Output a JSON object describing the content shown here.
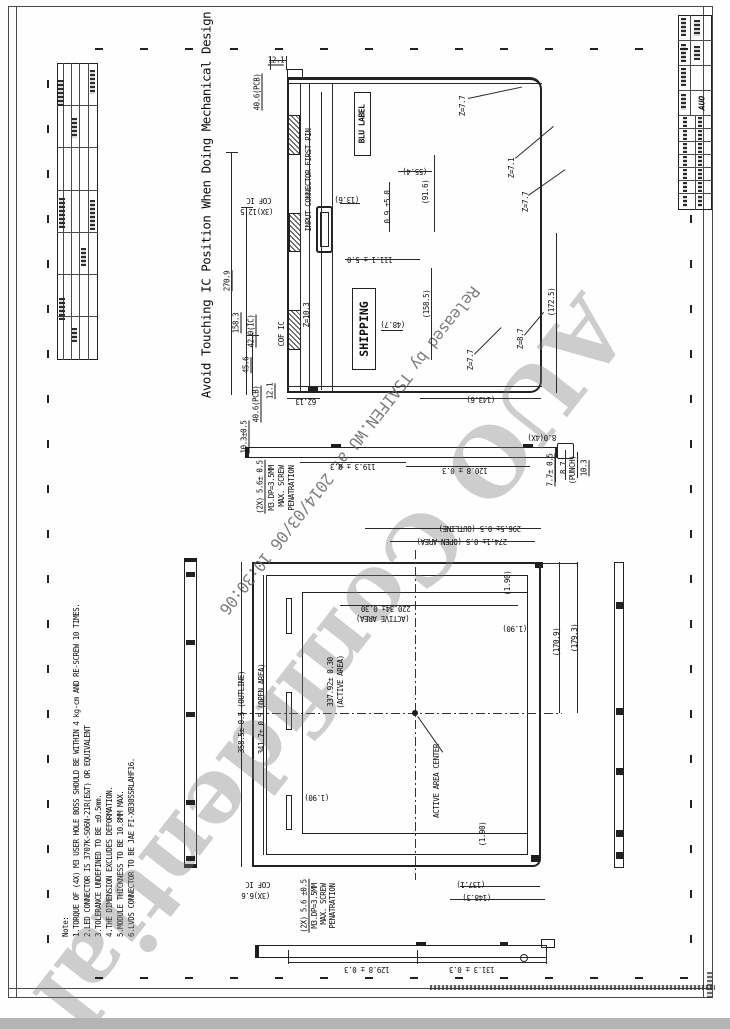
{
  "drawing": {
    "warning_title": "Avoid Touching IC Position When Doing Mechanical Design",
    "watermark_released": "Released by TSAIFEN.WU at 2014/03/06 10:30:06",
    "watermark_confidential": "AUO Confidential",
    "logo": "AUO",
    "blu_label": "BLU LABEL",
    "shipping_label": "SHIPPING"
  },
  "notes": {
    "heading": "Note:",
    "items": [
      "1.TORQUE OF (4X) M3 USER HOLE BOSS SHOULD BE WITHIN 4 kg-cm AND RE-SCREW 10 TIMES.",
      "2.LED CONNECTOR IS 3707K-S06N-21R(E&T) OR EQUIVALENT",
      "3.TOLERANCE UNDEFINED TO BE ±0.5mm.",
      "4.THE DIMENSION EXCLUDES DEFORMATION.",
      "5.MODULE THICKNESS TO BE 10.8MM MAX.",
      "6.LVDS CONNECTOR TO BE JAE FI-XB30SSRLAHF16."
    ]
  },
  "dims": [
    {
      "t": "12.1",
      "x": 276,
      "y": 61,
      "r": 0,
      "u": 1
    },
    {
      "t": "40.6(PCB)",
      "x": 258,
      "y": 92,
      "r": -90,
      "u": 1
    },
    {
      "t": "INPUT CONNECTOR FIRST PIN",
      "x": 309,
      "y": 180,
      "r": -90
    },
    {
      "t": "COF IC",
      "x": 259,
      "y": 200,
      "r": 180
    },
    {
      "t": "(3X)12.5",
      "x": 257,
      "y": 211,
      "r": 180
    },
    {
      "t": "(55.4)",
      "x": 415,
      "y": 171,
      "r": 180
    },
    {
      "t": "(13.6)",
      "x": 347,
      "y": 199,
      "r": 180
    },
    {
      "t": "0.9 ±5.0",
      "x": 388,
      "y": 207,
      "r": -90
    },
    {
      "t": "(91.6)",
      "x": 426,
      "y": 192,
      "r": -90
    },
    {
      "t": "Z=7.7",
      "x": 463,
      "y": 106,
      "r": -90
    },
    {
      "t": "Z=7.1",
      "x": 512,
      "y": 168,
      "r": -90
    },
    {
      "t": "Z=7.7",
      "x": 526,
      "y": 202,
      "r": -90
    },
    {
      "t": "111.1 ± 5.0",
      "x": 370,
      "y": 259,
      "r": 180
    },
    {
      "t": "Z=10.3",
      "x": 307,
      "y": 315,
      "r": -90
    },
    {
      "t": "COF IC",
      "x": 282,
      "y": 334,
      "r": -90
    },
    {
      "t": "42.0(IC)",
      "x": 252,
      "y": 331,
      "r": -90,
      "u": 1
    },
    {
      "t": "45.6",
      "x": 247,
      "y": 365,
      "r": -90,
      "u": 1
    },
    {
      "t": "158.3",
      "x": 237,
      "y": 323,
      "r": -90,
      "u": 1
    },
    {
      "t": "270.9",
      "x": 228,
      "y": 281,
      "r": -90,
      "u": 1
    },
    {
      "t": "(158.5)",
      "x": 427,
      "y": 304,
      "r": -90
    },
    {
      "t": "(48.7)",
      "x": 393,
      "y": 324,
      "r": 180
    },
    {
      "t": "Z=8.7",
      "x": 521,
      "y": 339,
      "r": -90
    },
    {
      "t": "(172.5)",
      "x": 552,
      "y": 302,
      "r": -90
    },
    {
      "t": "Z=7.7",
      "x": 471,
      "y": 360,
      "r": -90
    },
    {
      "t": "(143.6)",
      "x": 481,
      "y": 399,
      "r": 180
    },
    {
      "t": "62.13",
      "x": 306,
      "y": 401,
      "r": 180
    },
    {
      "t": "12.1",
      "x": 271,
      "y": 391,
      "r": -90,
      "u": 1
    },
    {
      "t": "40.6(PCB)",
      "x": 257,
      "y": 404,
      "r": -90,
      "u": 1
    },
    {
      "t": "10.3±0.5",
      "x": 245,
      "y": 437,
      "r": -90,
      "u": 1
    },
    {
      "t": "(2X) 5.6± 0.5",
      "x": 261,
      "y": 487,
      "r": -90,
      "u": 1
    },
    {
      "t": "M3.DP=3.5MM",
      "x": 272,
      "y": 488,
      "r": -90
    },
    {
      "t": "MAX. SCREW",
      "x": 282,
      "y": 486,
      "r": -90
    },
    {
      "t": "PENATRATION",
      "x": 292,
      "y": 488,
      "r": -90
    },
    {
      "t": "119.3 ± 0.3",
      "x": 353,
      "y": 466,
      "r": 180
    },
    {
      "t": "120.8 ± 0.3",
      "x": 465,
      "y": 470,
      "r": 180
    },
    {
      "t": "8.0(4X)",
      "x": 542,
      "y": 437,
      "r": 180
    },
    {
      "t": "7.7± 0.5",
      "x": 551,
      "y": 470,
      "r": -90,
      "u": 1
    },
    {
      "t": "8.7",
      "x": 564,
      "y": 468,
      "r": -90
    },
    {
      "t": "(PUNCH)",
      "x": 573,
      "y": 470,
      "r": -90
    },
    {
      "t": "10.3",
      "x": 585,
      "y": 468,
      "r": -90,
      "u": 1
    },
    {
      "t": "296.5± 0.5 (OUTLINE)",
      "x": 480,
      "y": 528,
      "r": 180
    },
    {
      "t": "274.1± 0.5 (OPEN AREA)",
      "x": 462,
      "y": 541,
      "r": 180
    },
    {
      "t": "220.34± 0.30",
      "x": 386,
      "y": 608,
      "r": 180
    },
    {
      "t": "(ACTIVE AREA)",
      "x": 383,
      "y": 618,
      "r": 180
    },
    {
      "t": "(1.90)",
      "x": 508,
      "y": 583,
      "r": -90
    },
    {
      "t": "(1.90)",
      "x": 515,
      "y": 628,
      "r": 180
    },
    {
      "t": "(170.9)",
      "x": 557,
      "y": 642,
      "r": -90
    },
    {
      "t": "(179.3)",
      "x": 575,
      "y": 638,
      "r": -90
    },
    {
      "t": "358.5± 0.5 (OUTLINE)",
      "x": 242,
      "y": 712,
      "r": -90
    },
    {
      "t": "341.7± 0.5 (OPEN AREA)",
      "x": 262,
      "y": 709,
      "r": -90
    },
    {
      "t": "337.92± 0.30",
      "x": 331,
      "y": 682,
      "r": -90
    },
    {
      "t": "(ACTIVE AREA)",
      "x": 341,
      "y": 682,
      "r": -90
    },
    {
      "t": "(1.90)",
      "x": 317,
      "y": 797,
      "r": 180
    },
    {
      "t": "ACTIVE AREA CENTER",
      "x": 437,
      "y": 781,
      "r": -90
    },
    {
      "t": "(1.90)",
      "x": 483,
      "y": 834,
      "r": -90
    },
    {
      "t": "(137.1)",
      "x": 471,
      "y": 884,
      "r": 180
    },
    {
      "t": "(148.3)",
      "x": 477,
      "y": 897,
      "r": 180
    },
    {
      "t": "COF IC",
      "x": 258,
      "y": 884,
      "r": 180
    },
    {
      "t": "(3X)6.6",
      "x": 256,
      "y": 895,
      "r": 180
    },
    {
      "t": "(2X) 5.6 ±0.5",
      "x": 305,
      "y": 906,
      "r": -90,
      "u": 1
    },
    {
      "t": "M3.DP=3.5MM",
      "x": 315,
      "y": 906,
      "r": -90
    },
    {
      "t": "MAX. SCREW",
      "x": 324,
      "y": 904,
      "r": -90
    },
    {
      "t": "PENATRATION",
      "x": 333,
      "y": 906,
      "r": -90
    },
    {
      "t": "131.3 ± 0.3",
      "x": 472,
      "y": 969,
      "r": 180
    },
    {
      "t": "129.8 ± 0.3",
      "x": 367,
      "y": 969,
      "r": 180
    }
  ]
}
